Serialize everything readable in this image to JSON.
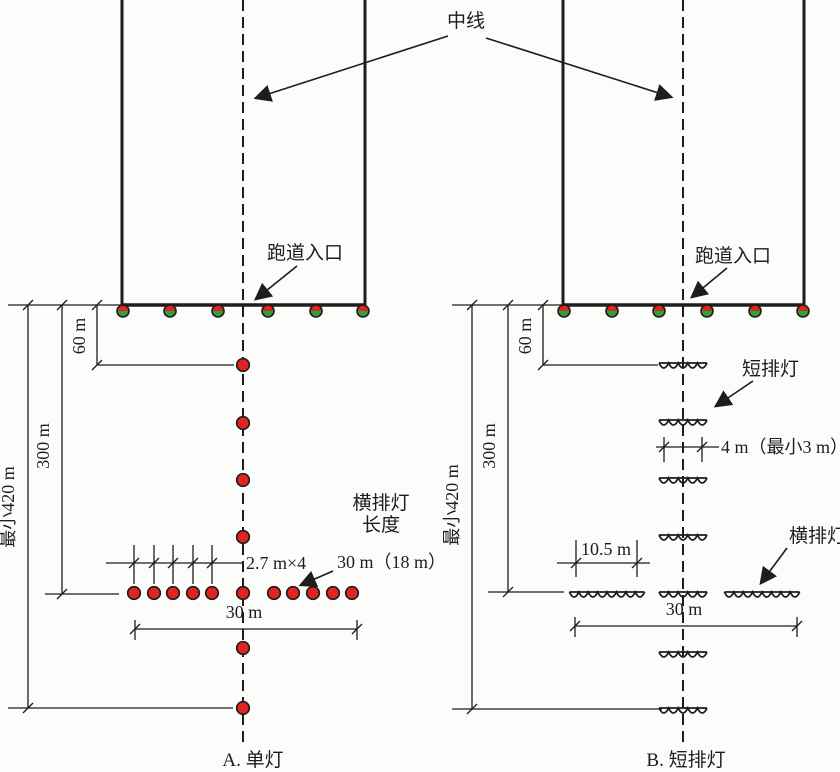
{
  "labels": {
    "centerline": "中线",
    "caption_a": "A. 单灯",
    "caption_b": "B. 短排灯"
  },
  "diagram_a": {
    "threshold": "跑道入口",
    "dim_60m": "60 m",
    "dim_300m": "300 m",
    "dim_420m": "最小420 m",
    "light_spacing": "2.7 m×4",
    "crossbar_length_value": "30 m（18 m）",
    "crossbar_width": "30 m",
    "crossbar_length_label1": "横排灯",
    "crossbar_length_label2": "长度"
  },
  "diagram_b": {
    "threshold": "跑道入口",
    "dim_60m": "60 m",
    "dim_300m": "300 m",
    "dim_420m": "最小420 m",
    "short_barrette": "短排灯",
    "barrette_length": "4 m（最小3 m）",
    "barrette_gap": "10.5 m",
    "crossbar": "横排灯",
    "crossbar_width": "30 m"
  },
  "colors": {
    "line": "#1d1d1b",
    "light_red": "#e02423",
    "light_green": "#2f9e3c",
    "background": "#fcfcfa"
  }
}
